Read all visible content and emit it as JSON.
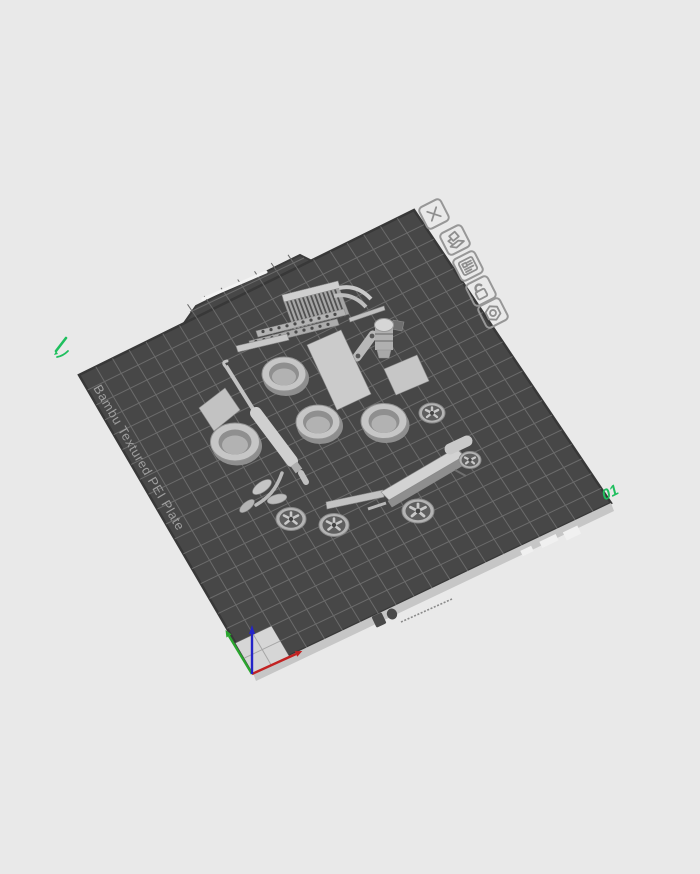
{
  "app": {
    "background_color": "#e9e9e9"
  },
  "plate": {
    "name_label": "Bambu Textured PEI Plate",
    "number_label": "01",
    "surface_color": "#474747",
    "grid_color": "#6b6b6b",
    "grid_divisions": 20,
    "edge_strip_color": "#c6c6c6",
    "tab_slot_color": "#f2f2f2",
    "name_label_color": "#9e9e9e",
    "accent_green": "#1fbf5e",
    "origin_square_color": "#d6d6d6"
  },
  "plate_toolbar": {
    "icons": [
      {
        "name": "delete-plate"
      },
      {
        "name": "orient-plate"
      },
      {
        "name": "plate-info"
      },
      {
        "name": "lock-plate"
      },
      {
        "name": "plate-settings"
      }
    ]
  },
  "origin_axes": {
    "x_color": "#c22222",
    "y_color": "#2aa52e",
    "z_color": "#2424c8"
  },
  "model_parts": [
    "fin-comb-bracket",
    "perforated-rail-upper",
    "perforated-rail-lower",
    "support-bar",
    "curved-runner",
    "thin-brace-bar",
    "link-capsule",
    "knob-cylinder",
    "awl-tool",
    "flat-plate",
    "tall-flat-bar",
    "small-flat-bar",
    "ring-cup-1",
    "ring-cup-2",
    "ring-cup-3",
    "ring-cup-4",
    "spoked-wheel-1",
    "spoked-wheel-2",
    "spoked-wheel-3",
    "spoked-wheel-4",
    "spoked-wheel-5",
    "sprout-leaves",
    "blaster-assembly",
    "small-peg-bar"
  ]
}
